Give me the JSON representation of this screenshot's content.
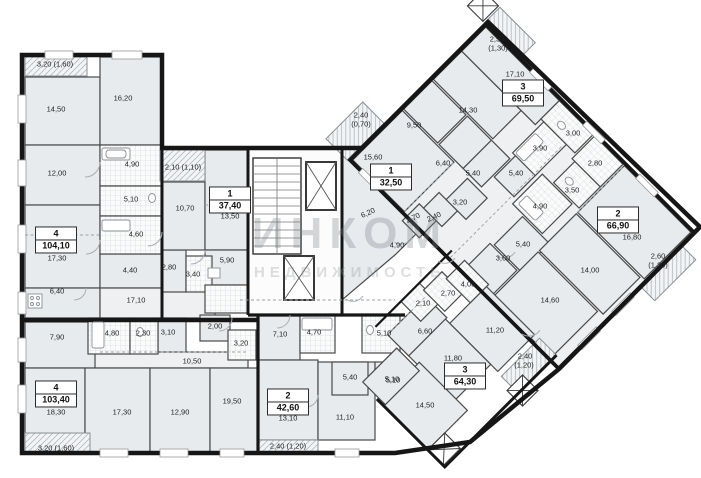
{
  "watermark": {
    "line1": "ИНКОМ",
    "line2": "НЕДВИЖИМОСТЬ"
  },
  "apartments": [
    {
      "rooms": "4",
      "total": "104,10",
      "living": "17,30"
    },
    {
      "rooms": "4",
      "total": "103,40",
      "living": "18,30"
    },
    {
      "rooms": "1",
      "total": "37,40",
      "living": "13,50"
    },
    {
      "rooms": "2",
      "total": "42,60",
      "living": "13,10"
    },
    {
      "rooms": "1",
      "total": "32,50"
    },
    {
      "rooms": "3",
      "total": "69,50"
    },
    {
      "rooms": "2",
      "total": "66,90"
    },
    {
      "rooms": "3",
      "total": "64,30"
    }
  ],
  "labels": [
    {
      "t": "3,20 (1,60)"
    },
    {
      "t": "14,50"
    },
    {
      "t": "16,20"
    },
    {
      "t": "12,00"
    },
    {
      "t": "4,90"
    },
    {
      "t": "2,10 (1,10)"
    },
    {
      "t": "5,10"
    },
    {
      "t": "10,70"
    },
    {
      "t": "4,60"
    },
    {
      "t": "4,40"
    },
    {
      "t": "2,80"
    },
    {
      "t": "3,40"
    },
    {
      "t": "5,90"
    },
    {
      "t": "6,40"
    },
    {
      "t": "17,10"
    },
    {
      "t": "7,90"
    },
    {
      "t": "4,80"
    },
    {
      "t": "2,30"
    },
    {
      "t": "3,10"
    },
    {
      "t": "2,00"
    },
    {
      "t": "10,50"
    },
    {
      "t": "3,20"
    },
    {
      "t": "17,30"
    },
    {
      "t": "12,90"
    },
    {
      "t": "19,50"
    },
    {
      "t": "3,20 (1,60)"
    },
    {
      "t": "7,10"
    },
    {
      "t": "4,70"
    },
    {
      "t": "5,10"
    },
    {
      "t": "5,40"
    },
    {
      "t": "5,10"
    },
    {
      "t": "11,10"
    },
    {
      "t": "2,40 (1,20)"
    },
    {
      "t": "2,40"
    },
    {
      "t": "(0,70)"
    },
    {
      "t": "15,60"
    },
    {
      "t": "6,20"
    },
    {
      "t": "9,50"
    },
    {
      "t": "14,30"
    },
    {
      "t": "2,50"
    },
    {
      "t": "(1,30)"
    },
    {
      "t": "17,10"
    },
    {
      "t": "6,40"
    },
    {
      "t": "5,40"
    },
    {
      "t": "5,40"
    },
    {
      "t": "3,20"
    },
    {
      "t": "2,70"
    },
    {
      "t": "2,40"
    },
    {
      "t": "4,90"
    },
    {
      "t": "3,00"
    },
    {
      "t": "3,90"
    },
    {
      "t": "2,80"
    },
    {
      "t": "3,50"
    },
    {
      "t": "4,90"
    },
    {
      "t": "16,80"
    },
    {
      "t": "5,40"
    },
    {
      "t": "3,60"
    },
    {
      "t": "14,00"
    },
    {
      "t": "2,60"
    },
    {
      "t": "(1,30)"
    },
    {
      "t": "14,60"
    },
    {
      "t": "4,00"
    },
    {
      "t": "2,70"
    },
    {
      "t": "2,10"
    },
    {
      "t": "6,60"
    },
    {
      "t": "11,20"
    },
    {
      "t": "11,80"
    },
    {
      "t": "2,40"
    },
    {
      "t": "(1,20)"
    },
    {
      "t": "5,10"
    },
    {
      "t": "14,50"
    }
  ]
}
